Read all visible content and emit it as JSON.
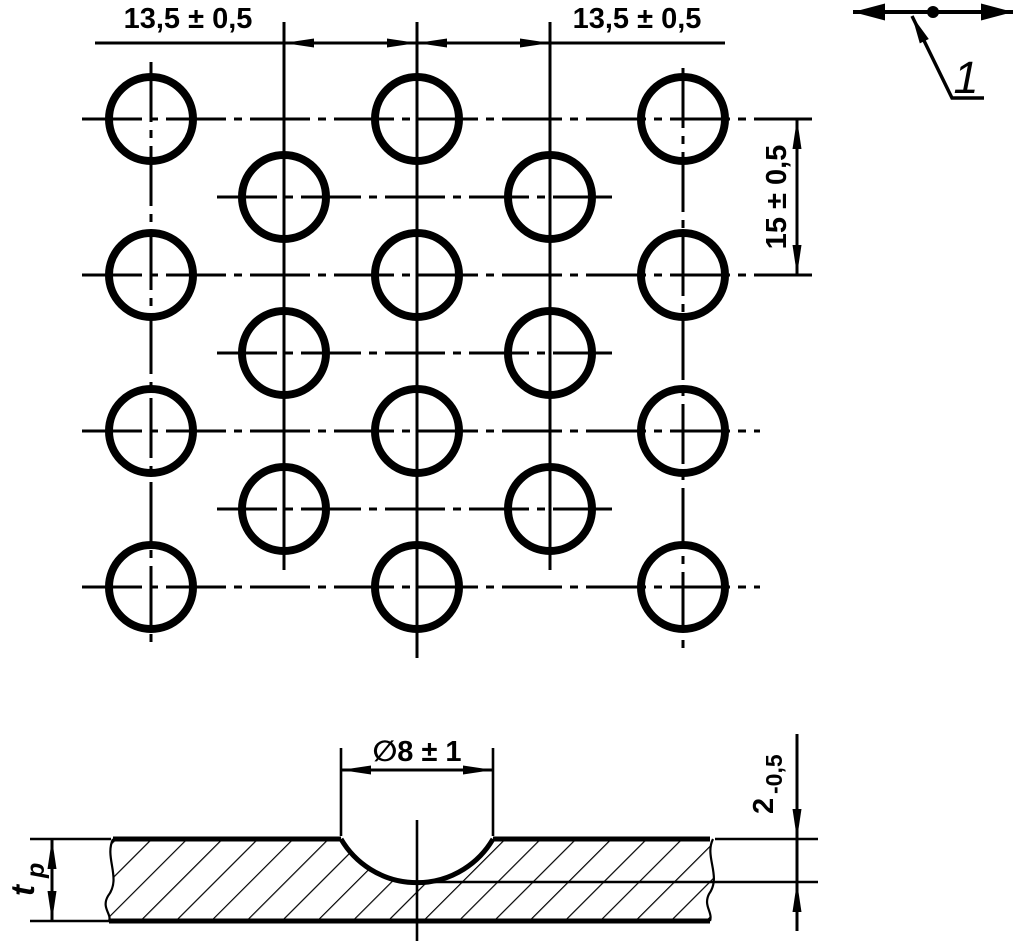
{
  "colors": {
    "ink": "#000000",
    "paper": "#ffffff"
  },
  "plan_view": {
    "dimensions": {
      "pitch_left": "13,5 ± 0,5",
      "pitch_right": "13,5 ± 0,5",
      "row_spacing": "15 ± 0,5"
    },
    "callout": {
      "label": "1"
    },
    "grid": {
      "columns_x": [
        151,
        284,
        417,
        550,
        683
      ],
      "rows_y": [
        119,
        197,
        275,
        353,
        431,
        509,
        587
      ],
      "main_row_column_indices": [
        0,
        2,
        4
      ],
      "offset_row_column_indices": [
        1,
        3
      ],
      "hole_radius": 42,
      "hole_stroke": 8
    }
  },
  "section_view": {
    "dimensions": {
      "dimple_diameter": "∅8 ± 1",
      "depth_value": "2",
      "depth_tolerance": "-0,5",
      "thickness_symbol": "t",
      "thickness_subscript": "p"
    }
  }
}
